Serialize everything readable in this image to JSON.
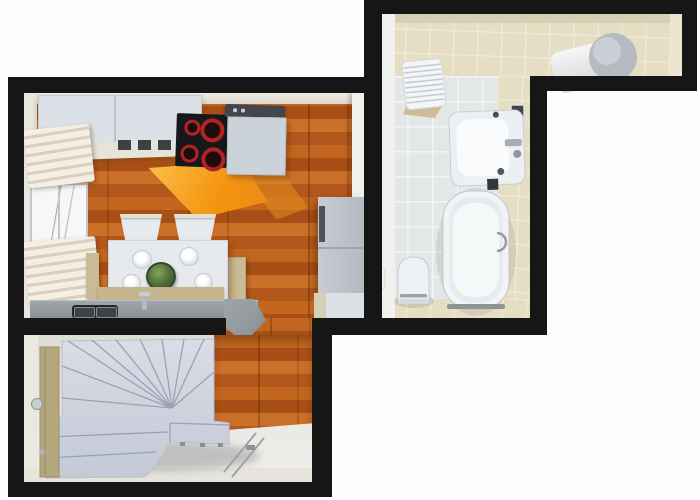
{
  "scene": {
    "kind": "3d-floorplan-top-down-render",
    "text_visible": "none",
    "rooms": [
      {
        "id": "kitchen-dining",
        "flooring": "orange wood planks with sunlight patch",
        "fixtures": [
          "upper-cabinets",
          "cooktop-4-burners",
          "range-hood",
          "kitchen-cabinet",
          "refrigerator",
          "roman-blind-upper",
          "window",
          "roman-blind-lower",
          "dining-table",
          "dining-chair",
          "dining-chair",
          "plate",
          "plate",
          "plate",
          "plate",
          "centerpiece-bowl",
          "bench",
          "bench",
          "bench-front",
          "counter",
          "double-sink",
          "faucet"
        ]
      },
      {
        "id": "bathroom",
        "flooring": "white and beige ceramic tiles",
        "fixtures": [
          "towel-stack",
          "water-heater",
          "washbasin",
          "basin-faucet",
          "mirror",
          "bathtub",
          "tub-handle",
          "toilet",
          "toilet-paper-holder",
          "soap-dish"
        ]
      },
      {
        "id": "stair-hall",
        "flooring": "light screed with wood strip at opening",
        "fixtures": [
          "winder-staircase",
          "bottom-step",
          "entrance-door",
          "door-handle",
          "floor-door-track"
        ]
      }
    ]
  },
  "palette": {
    "wall": "#161616",
    "wood-a": "#c2661f",
    "wood-b": "#a84f17",
    "wood-c": "#cb7028",
    "wood-d": "#b3581c",
    "tile-white": "#e3e7e7",
    "tile-beige": "#e6dec4",
    "cabinet": "#dce1e7",
    "counter-a": "#a0a7ac",
    "counter-b": "#878e93",
    "bench": "#c8bb95",
    "table-white": "#e7eaed",
    "fixture-white": "#f1f4f6",
    "steps-a": "#d9dde6",
    "steps-b": "#c3c9d6",
    "step-line": "#9aa2b2",
    "door-tan": "#b5a77d",
    "fridge-a": "#c7ccd2",
    "fridge-b": "#b4bac2",
    "sun-a": "#ffc54f",
    "sun-b": "#f7980f",
    "burner-red": "#b32222",
    "stove-black": "#17181c"
  }
}
